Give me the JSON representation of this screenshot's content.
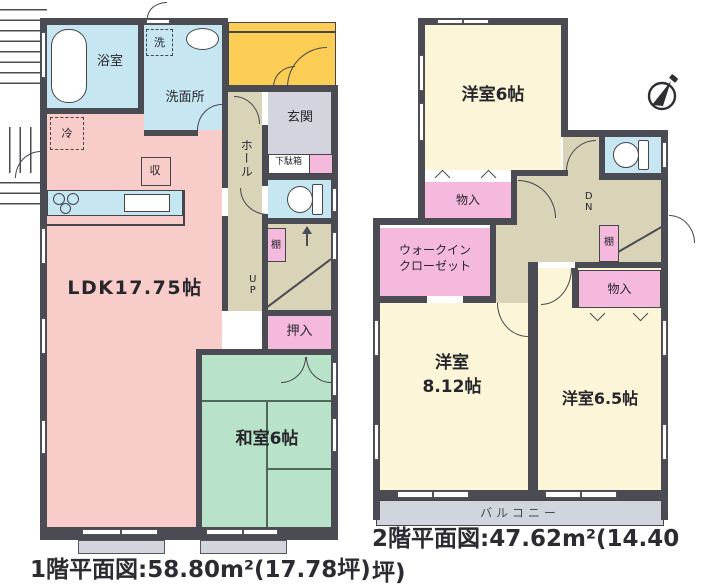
{
  "floor1": {
    "caption": "1階平面図:58.80m²(17.78坪)",
    "labels": {
      "bath": "浴室",
      "laundry": "洗",
      "washroom": "洗面所",
      "entrance": "玄関",
      "shoe_cabinet": "下駄箱",
      "hall": "ホール",
      "fridge": "冷",
      "storage": "収",
      "ldk": "LDK17.75帖",
      "stairs_up": "UP",
      "shelf": "棚",
      "closet": "押入",
      "japanese_room": "和室6帖"
    }
  },
  "floor2": {
    "caption": "2階平面図:47.62m²(14.40坪)",
    "labels": {
      "bedroom6": "洋室6帖",
      "storage_upper": "物入",
      "wic_line1": "ウォークイン",
      "wic_line2": "クローゼット",
      "stairs_down": "DN",
      "shelf": "棚",
      "storage_right": "物入",
      "bedroom8_line1": "洋室",
      "bedroom8_line2": "8.12帖",
      "bedroom65": "洋室6.5帖",
      "balcony": "バルコニー"
    }
  },
  "colors": {
    "wall": "#4b4b53",
    "water_cyan": "#c6e7f2",
    "ldk_pink": "#f8ccc8",
    "closet_pink": "#f5b9de",
    "tatami_green": "#b9e3c9",
    "bedroom_cream": "#fcf5d8",
    "porch_yellow": "#fccd55",
    "hall_beige": "#d9d3b8",
    "entrance_gray": "#d4d4de",
    "balcony_gray": "#d0d5de"
  }
}
